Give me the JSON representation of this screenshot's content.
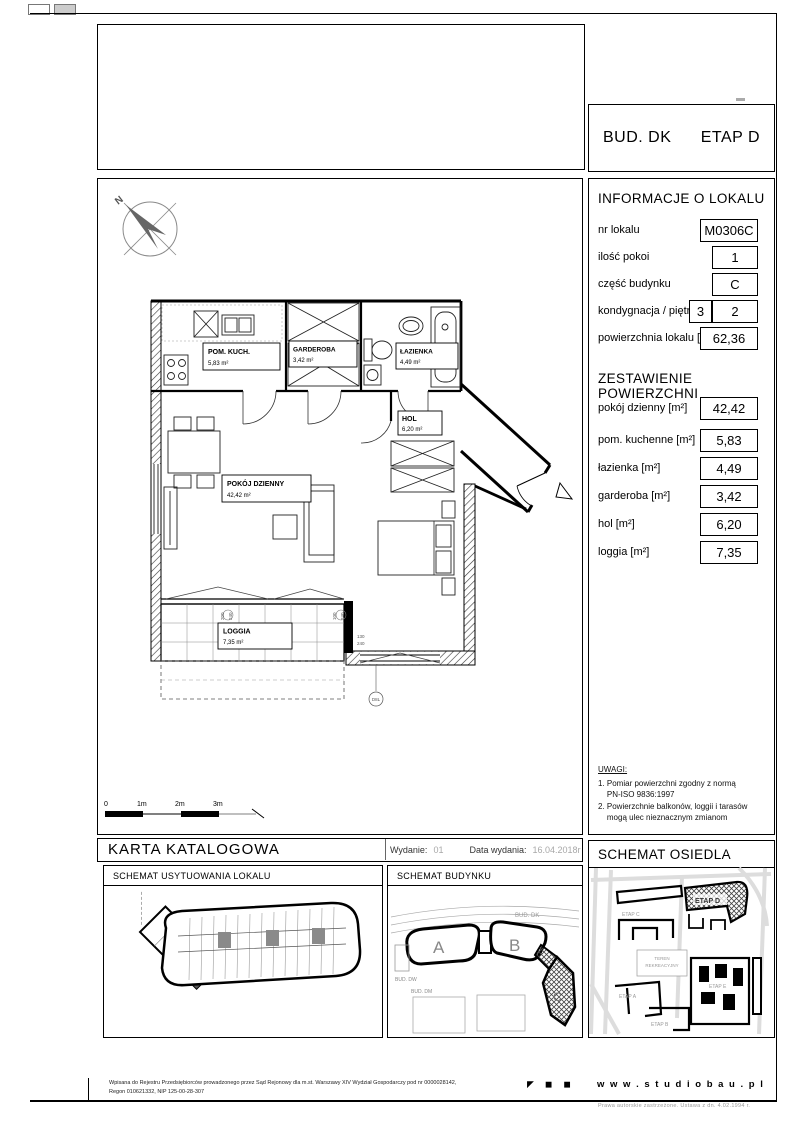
{
  "header": {
    "building": "BUD. DK",
    "stage": "ETAP D"
  },
  "info": {
    "title": "INFORMACJE O LOKALU",
    "fields": [
      {
        "label": "nr lokalu",
        "value": "M0306C"
      },
      {
        "label": "ilość pokoi",
        "value": "1"
      },
      {
        "label": "część budynku",
        "value": "C"
      },
      {
        "label": "kondygnacja / piętro",
        "storey": "3",
        "floor": "2"
      },
      {
        "label": "powierzchnia lokalu [m²]",
        "value": "62,36"
      }
    ],
    "areas_title": "ZESTAWIENIE POWIERZCHNI",
    "areas": [
      {
        "label": "pokój dzienny [m²]",
        "value": "42,42"
      },
      {
        "label": "pom. kuchenne [m²]",
        "value": "5,83"
      },
      {
        "label": "łazienka [m²]",
        "value": "4,49"
      },
      {
        "label": "garderoba  [m²]",
        "value": "3,42"
      },
      {
        "label": "hol [m²]",
        "value": "6,20"
      },
      {
        "label": "loggia [m²]",
        "value": "7,35"
      }
    ],
    "notes_title": "UWAGI:",
    "notes": [
      "1. Pomiar powierzchni zgodny z normą\n    PN-ISO 9836:1997",
      "2. Powierzchnie balkonów, loggii i tarasów\n    mogą ulec nieznacznym zmianom"
    ]
  },
  "plan": {
    "compass": "N",
    "rooms": {
      "kitchen": {
        "name": "POM. KUCH.",
        "area": "5,83 m²"
      },
      "wardrobe": {
        "name": "GARDEROBA",
        "area": "3,42 m²"
      },
      "bath": {
        "name": "ŁAZIENKA",
        "area": "4,49 m²"
      },
      "hall": {
        "name": "HOL",
        "area": "6,20 m²"
      },
      "living": {
        "name": "POKÓJ DZIENNY",
        "area": "42,42 m²"
      },
      "loggia": {
        "name": "LOGGIA",
        "area": "7,35 m²"
      }
    },
    "dims": {
      "w1": "200",
      "h1": "240",
      "w2": "100",
      "h2": "240",
      "w3": "130",
      "h3": "240",
      "mark": "D8L"
    },
    "scale": {
      "s0": "0",
      "s1": "1m",
      "s2": "2m",
      "s3": "3m"
    }
  },
  "catalog": {
    "title": "KARTA KATALOGOWA",
    "edition_label": "Wydanie:",
    "edition_value": "01",
    "date_label": "Data wydania:",
    "date_value": "16.04.2018r"
  },
  "schemas": {
    "location_title": "SCHEMAT USYTUOWANIA LOKALU",
    "building_title": "SCHEMAT BUDYNKU",
    "estate_title": "SCHEMAT OSIEDLA",
    "building_labels": {
      "a": "A",
      "b": "B",
      "c": "C",
      "bud_dk": "BUD. DK",
      "bud_dw": "BUD. DW",
      "bud_dm": "BUD. DM"
    },
    "estate_labels": {
      "etap_a": "ETAP A",
      "etap_b": "ETAP B",
      "etap_c": "ETAP C",
      "etap_d": "ETAP D",
      "etap_e": "ETAP E",
      "teren1": "TEREN",
      "teren2": "REKREACYJNY"
    }
  },
  "footer": {
    "registry_line1": "Wpisana do Rejestru Przedsiębiorców prowadzonego przez Sąd Rejonowy dla m.st. Warszawy XIV Wydział Gospodarczy pod nr 0000028142,",
    "registry_line2": "Regon 010621332, NIP 125-00-28-307",
    "logo_glyphs": [
      "◤",
      "◼",
      "◼"
    ],
    "website": "w w w . s t u d i o b a u . p l",
    "copyright": "Prawa autorskie zastrzeżone. Ustawa z dn. 4.02.1994 r."
  },
  "colors": {
    "highlight": "#5a5a5a",
    "hatch": "#333333",
    "muted": "#999999"
  }
}
